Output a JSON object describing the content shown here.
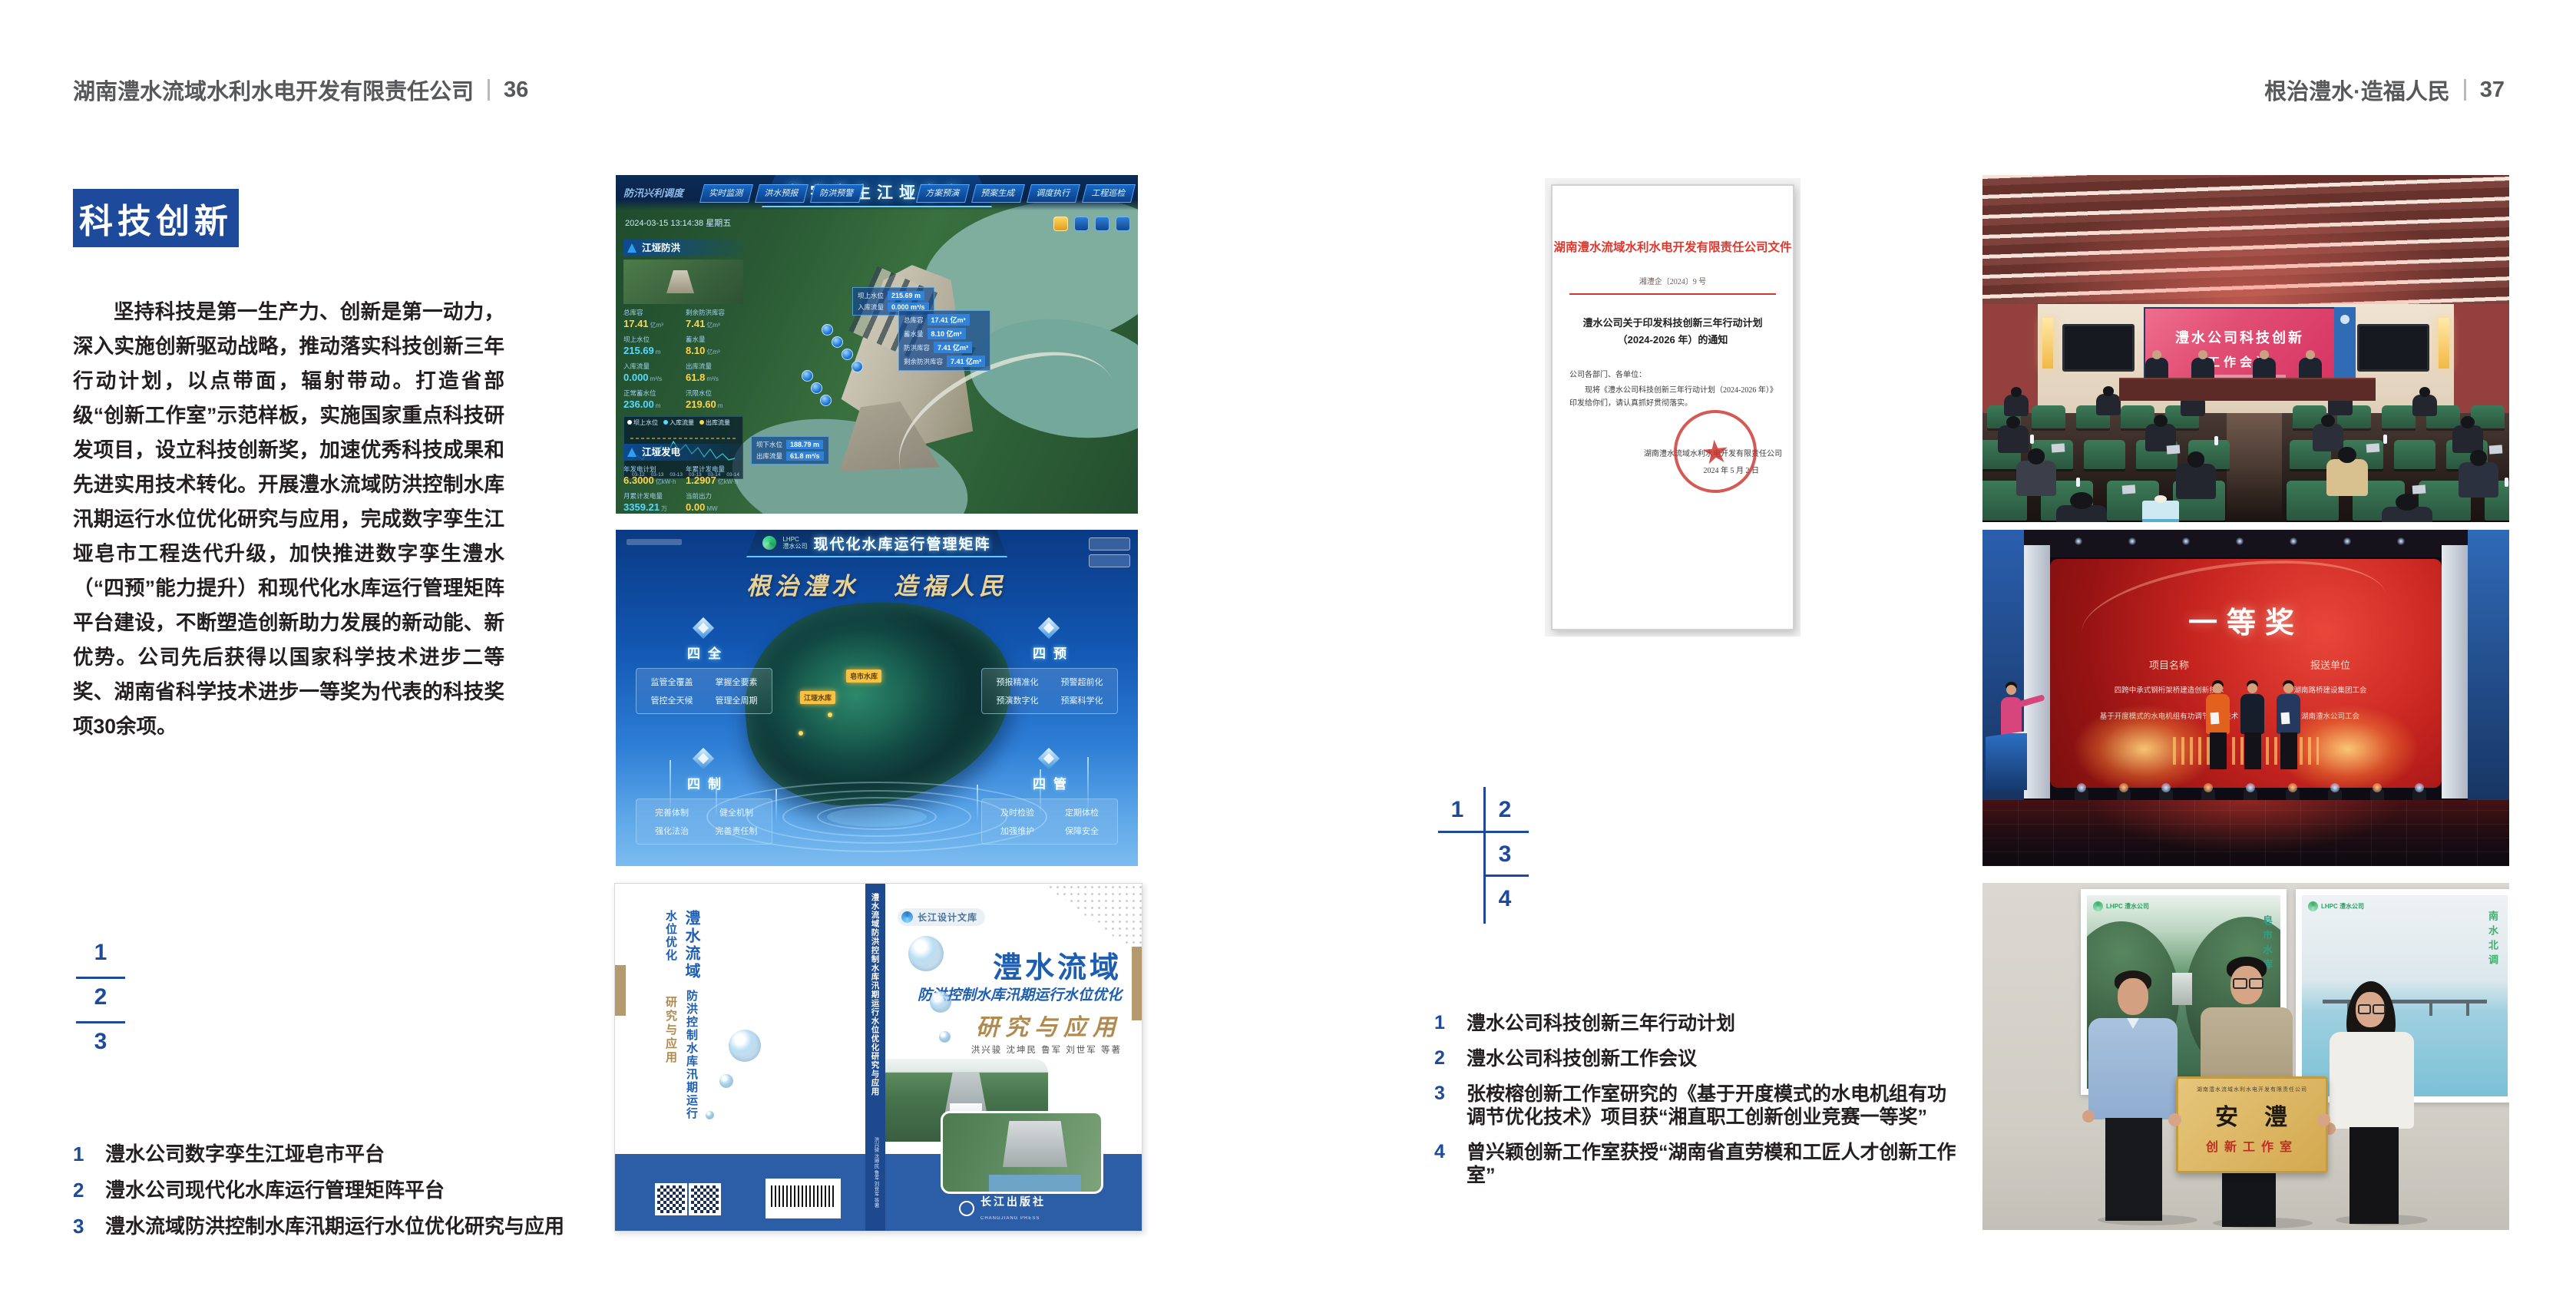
{
  "colors": {
    "accent": "#1d4a9b",
    "header_gray": "#58595b"
  },
  "page_left": {
    "header": {
      "company": "湖南澧水流域水利水电开发有限责任公司",
      "divider": "|",
      "page_no": "36"
    },
    "section_title": "科技创新",
    "body": "坚持科技是第一生产力、创新是第一动力，深入实施创新驱动战略，推动落实科技创新三年行动计划，以点带面，辐射带动。打造省部级“创新工作室”示范样板，实施国家重点科技研发项目，设立科技创新奖，加速优秀科技成果和先进实用技术转化。开展澧水流域防洪控制水库汛期运行水位优化研究与应用，完成数字孪生江垭皂市工程迭代升级，加快推进数字孪生澧水（“四预”能力提升）和现代化水库运行管理矩阵平台建设，不断塑造创新助力发展的新动能、新优势。公司先后获得以国家科学技术进步二等奖、湖南省科学技术进步一等奖为代表的科技奖项30余项。",
    "figure_markers": [
      "1",
      "2",
      "3"
    ],
    "captions": [
      {
        "num": "1",
        "text": "澧水公司数字孪生江垭皂市平台"
      },
      {
        "num": "2",
        "text": "澧水公司现代化水库运行管理矩阵平台"
      },
      {
        "num": "3",
        "text": "澧水流域防洪控制水库汛期运行水位优化研究与应用"
      }
    ]
  },
  "page_right": {
    "header": {
      "motto": "根治澧水·造福人民",
      "divider": "|",
      "page_no": "37"
    },
    "figure_markers": [
      "1",
      "2",
      "3",
      "4"
    ],
    "captions": [
      {
        "num": "1",
        "text": "澧水公司科技创新三年行动计划"
      },
      {
        "num": "2",
        "text": "澧水公司科技创新工作会议"
      },
      {
        "num": "3",
        "text": "张桉榕创新工作室研究的《基于开度模式的水电机组有功调节优化技术》项目获“湘直职工创新创业竞赛一等奖”"
      },
      {
        "num": "4",
        "text": "曾兴颖创新工作室获授“湖南省直劳模和工匠人才创新工作室”"
      }
    ]
  },
  "digital_twin": {
    "title": "数字孪生江垭皂市",
    "module_label": "防汛兴利调度",
    "tabs_left": [
      "实时监测",
      "洪水预报",
      "防洪预警"
    ],
    "tabs_right": [
      "方案预演",
      "预案生成",
      "调度执行",
      "工程巡检"
    ],
    "datetime": "2024-03-15 13:14:38 星期五",
    "panel_flood": {
      "title": "江垭防洪",
      "stats": [
        {
          "label": "总库容",
          "value": "17.41",
          "unit": "亿m³"
        },
        {
          "label": "剩余防洪库容",
          "value": "7.41",
          "unit": "亿m³"
        },
        {
          "label": "坝上水位",
          "value": "215.69",
          "unit": "m"
        },
        {
          "label": "蓄水量",
          "value": "8.10",
          "unit": "亿m³"
        },
        {
          "label": "入库流量",
          "value": "0.000",
          "unit": "m³/s"
        },
        {
          "label": "出库流量",
          "value": "61.8",
          "unit": "m³/s"
        },
        {
          "label": "正常蓄水位",
          "value": "236.00",
          "unit": "m"
        },
        {
          "label": "汛限水位",
          "value": "219.60",
          "unit": "m"
        }
      ]
    },
    "legend": [
      "坝上水位",
      "入库流量",
      "出库流量"
    ],
    "chart_dates": [
      "03-12",
      "03-13",
      "03-13",
      "03-13",
      "03-14",
      "03-14"
    ],
    "panel_power": {
      "title": "江垭发电",
      "stats": [
        {
          "label": "年发电计划",
          "value": "6.3000",
          "unit": "亿kW·h"
        },
        {
          "label": "年累计发电量",
          "value": "1.2907",
          "unit": "亿kW·h"
        },
        {
          "label": "月累计发电量",
          "value": "3359.21",
          "unit": "万kW·h"
        },
        {
          "label": "当前出力",
          "value": "0.00",
          "unit": "MW"
        },
        {
          "label": "发电流量",
          "value": "0.00",
          "unit": "m³/s"
        },
        {
          "label": "弃水流量",
          "value": "0.00",
          "unit": "m³/s"
        }
      ]
    },
    "gauge_values": [
      "0.00",
      "100.98",
      "0.00"
    ],
    "tooltip_up": {
      "rows": [
        [
          "坝上水位",
          "215.69 m"
        ],
        [
          "入库流量",
          "0.000 m³/s"
        ]
      ]
    },
    "tooltip_right": {
      "rows": [
        [
          "总库容",
          "17.41 亿m³"
        ],
        [
          "蓄水量",
          "8.10 亿m³"
        ],
        [
          "防洪库容",
          "7.41 亿m³"
        ],
        [
          "剩余防洪库容",
          "7.41 亿m³"
        ]
      ]
    },
    "tooltip_down": {
      "rows": [
        [
          "坝下水位",
          "188.79 m"
        ],
        [
          "出库流量",
          "61.8 m³/s"
        ]
      ]
    }
  },
  "matrix": {
    "logo_line1": "LHPC",
    "logo_line2": "澧水公司",
    "title": "现代化水库运行管理矩阵",
    "slogan_1": "根治澧水",
    "slogan_2": "造福人民",
    "panels": [
      {
        "name": "四全",
        "items": [
          "监管全覆盖",
          "掌握全要素",
          "管控全天候",
          "管理全周期"
        ]
      },
      {
        "name": "四预",
        "items": [
          "预报精准化",
          "预警超前化",
          "预演数字化",
          "预案科学化"
        ]
      },
      {
        "name": "四制",
        "items": [
          "完善体制",
          "健全机制",
          "强化法治",
          "完善责任制"
        ]
      },
      {
        "name": "四管",
        "items": [
          "及时检验",
          "定期体检",
          "加强维护",
          "保障安全"
        ]
      }
    ],
    "map_labels": [
      "皂市水库",
      "江垭水库"
    ]
  },
  "book": {
    "series_badge": "长江设计文库",
    "title_main": "澧水流域",
    "title_sub": "防洪控制水库汛期运行水位优化",
    "title_tail": "研究与应用",
    "authors": "洪兴骏 沈坤民 鲁军 刘世军 等著",
    "spine_text": "澧水流域防洪控制水库汛期运行水位优化研究与应用",
    "publisher": "长江出版社",
    "publisher_en": "CHANGJIANG PRESS"
  },
  "document": {
    "header": "湖南澧水流域水利水电开发有限责任公司文件",
    "doc_no": "湘澧企〔2024〕9 号",
    "title_line1": "澧水公司关于印发科技创新三年行动计划",
    "title_line2": "（2024-2026 年）的通知",
    "salutation": "公司各部门、各单位：",
    "body": "现将《澧水公司科技创新三年行动计划（2024-2026 年）》印发给你们，请认真抓好贯彻落实。",
    "seal_star": "★",
    "signer": "湖南澧水流域水利水电开发有限责任公司",
    "date": "2024 年 5 月 2 日"
  },
  "meeting": {
    "screen_line1": "澧水公司科技创新",
    "screen_line2": "工作会议"
  },
  "stage": {
    "award": "一等奖",
    "col1": "项目名称",
    "col2": "报送单位",
    "rows": [
      [
        "四跨中承式钢桁架桥建造创新技术",
        "湖南路桥建设集团工会"
      ],
      [
        "基于开度模式的水电机组有功调节优化技术",
        "湖南澧水公司工会"
      ]
    ]
  },
  "group_photo": {
    "poster_logo_text": "LHPC 澧水公司",
    "poster_left_caption": "皂市水库",
    "poster_right_caption": "南水北调",
    "plaque_org": "湖南澧水流域水利水电开发有限责任公司",
    "plaque_title": "安　澧",
    "plaque_sub": "创新工作室"
  }
}
